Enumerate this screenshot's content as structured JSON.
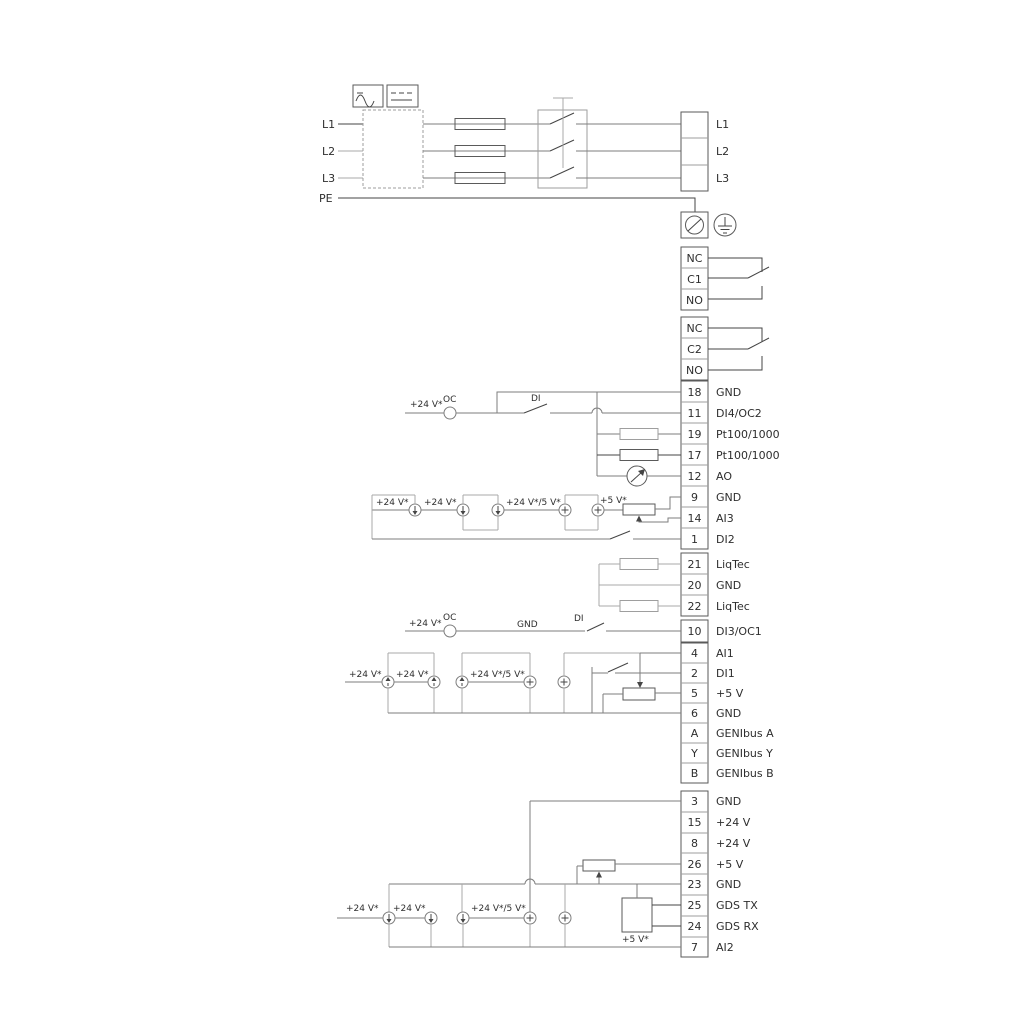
{
  "power": {
    "in_l1": "L1",
    "in_l2": "L2",
    "in_l3": "L3",
    "in_pe": "PE",
    "out": [
      {
        "label": "L1"
      },
      {
        "label": "L2"
      },
      {
        "label": "L3"
      }
    ]
  },
  "relay1": {
    "nc": "NC",
    "c": "C1",
    "no": "NO"
  },
  "relay2": {
    "nc": "NC",
    "c": "C2",
    "no": "NO"
  },
  "g1": {
    "v24": "+24 V*",
    "oc": "OC",
    "di": "DI",
    "rows": [
      {
        "id": "18",
        "label": "GND"
      },
      {
        "id": "11",
        "label": "DI4/OC2"
      },
      {
        "id": "19",
        "label": "Pt100/1000"
      },
      {
        "id": "17",
        "label": "Pt100/1000"
      },
      {
        "id": "12",
        "label": "AO"
      },
      {
        "id": "9",
        "label": "GND"
      },
      {
        "id": "14",
        "label": "AI3"
      },
      {
        "id": "1",
        "label": "DI2"
      }
    ],
    "s1": "+24 V*",
    "s2": "+24 V*",
    "s3": "+24 V*/5 V*",
    "s4": "+5 V*"
  },
  "liqtec": {
    "rows": [
      {
        "id": "21",
        "label": "LiqTec"
      },
      {
        "id": "20",
        "label": "GND"
      },
      {
        "id": "22",
        "label": "LiqTec"
      }
    ]
  },
  "g2": {
    "v24": "+24 V*",
    "oc": "OC",
    "gnd": "GND",
    "di": "DI",
    "row10": {
      "id": "10",
      "label": "DI3/OC1"
    },
    "rows": [
      {
        "id": "4",
        "label": "AI1"
      },
      {
        "id": "2",
        "label": "DI1"
      },
      {
        "id": "5",
        "label": "+5 V"
      },
      {
        "id": "6",
        "label": "GND"
      },
      {
        "id": "A",
        "label": "GENIbus A"
      },
      {
        "id": "Y",
        "label": "GENIbus Y"
      },
      {
        "id": "B",
        "label": "GENIbus B"
      }
    ],
    "s1": "+24 V*",
    "s2": "+24 V*",
    "s3": "+24 V*/5 V*"
  },
  "g3": {
    "rows": [
      {
        "id": "3",
        "label": "GND"
      },
      {
        "id": "15",
        "label": "+24 V"
      },
      {
        "id": "8",
        "label": "+24 V"
      },
      {
        "id": "26",
        "label": "+5 V"
      },
      {
        "id": "23",
        "label": "GND"
      },
      {
        "id": "25",
        "label": "GDS TX"
      },
      {
        "id": "24",
        "label": "GDS RX"
      },
      {
        "id": "7",
        "label": "AI2"
      }
    ],
    "s1": "+24 V*",
    "s2": "+24 V*",
    "s3": "+24 V*/5 V*",
    "s4": "+5 V*"
  }
}
